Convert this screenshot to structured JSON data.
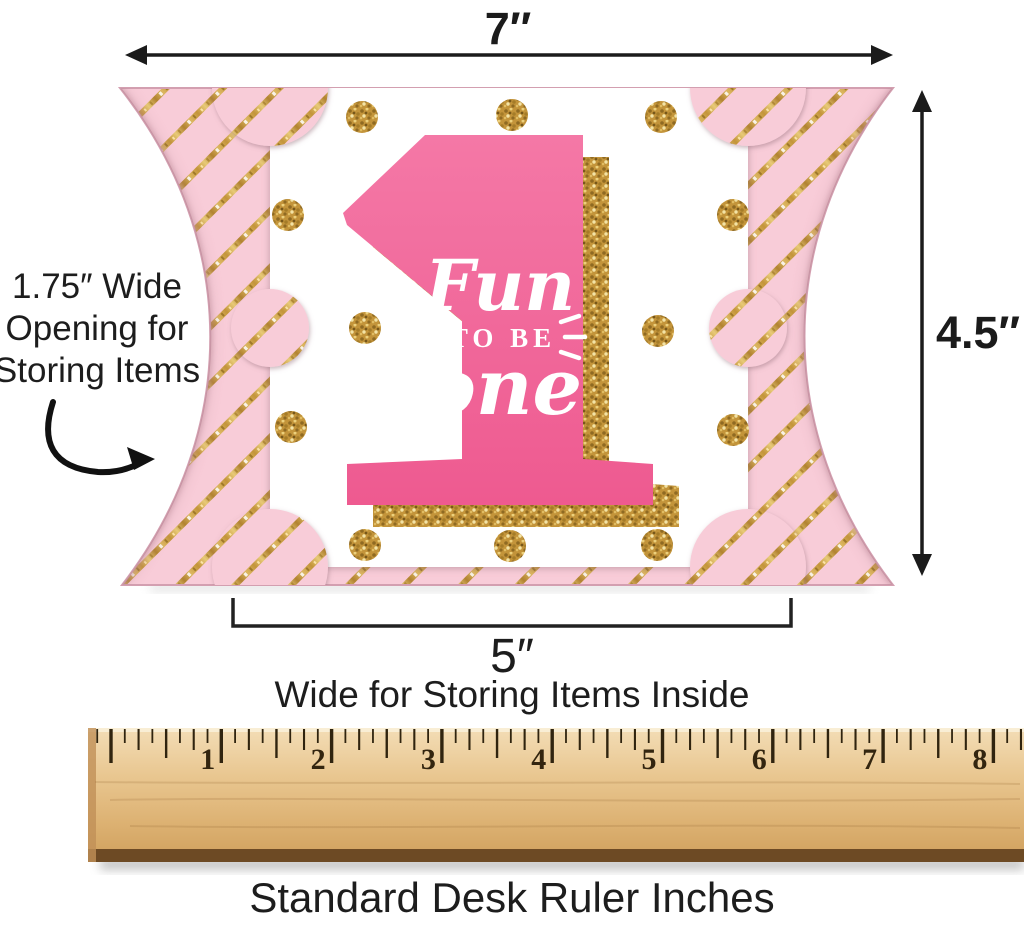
{
  "title": "Fun to be One favor pillow box dimension diagram",
  "dimensions": {
    "width_label": "7″",
    "height_label": "4.5″",
    "opening_lines": [
      "1.75″ Wide",
      "Opening for",
      "Storing Items"
    ],
    "inner_width_label": "5″",
    "inner_width_caption": "Wide for Storing Items Inside"
  },
  "box_art": {
    "word1": "Fun",
    "word2": "TO BE",
    "word3": "one",
    "numeral": "1"
  },
  "ruler": {
    "numbers": [
      "1",
      "2",
      "3",
      "4",
      "5",
      "6",
      "7",
      "8"
    ],
    "caption": "Standard Desk Ruler Inches"
  },
  "colors": {
    "pink_paper": "#f8ccd8",
    "gold_stripe": "#c3943a",
    "numeral_pink": "#f0679b",
    "wood_light": "#f0d8ad",
    "wood_dark": "#6d4a24",
    "ink": "#1b1b1b"
  }
}
